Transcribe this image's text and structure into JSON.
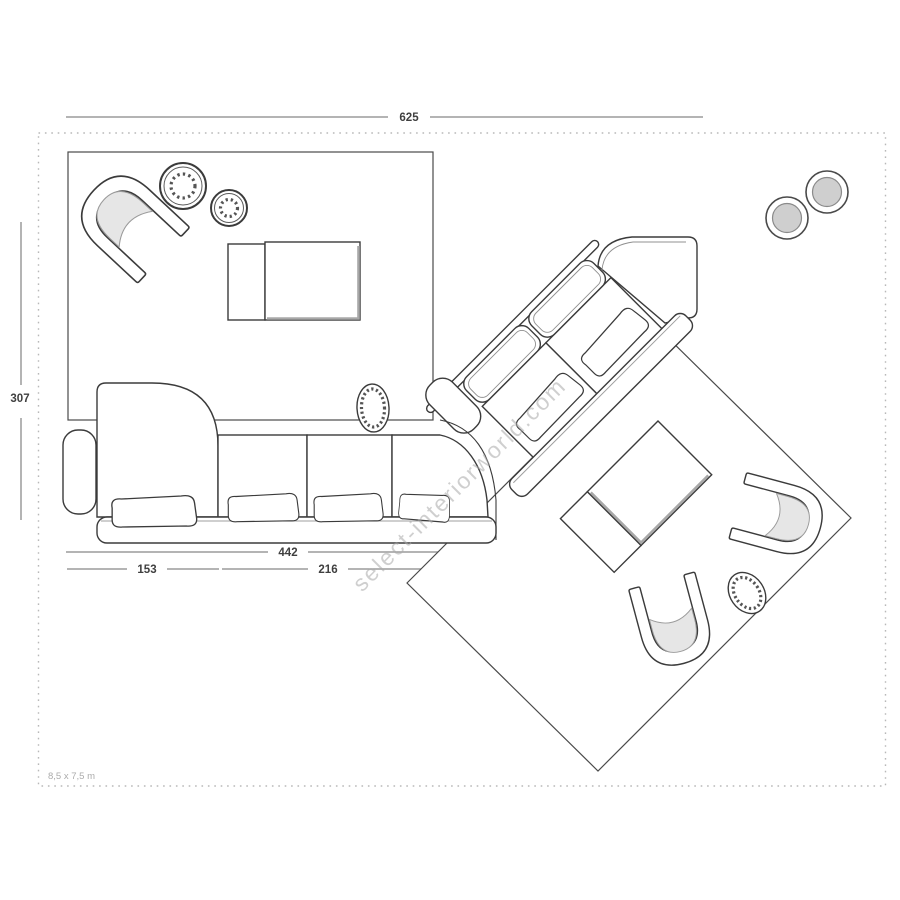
{
  "watermark": "select-interiorworld.com",
  "plan": {
    "room_size_label": "8,5 x 7,5 m",
    "dimensions": {
      "total_width": "625",
      "left_depth": "307",
      "sofa_total": "442",
      "chaise_section": "153",
      "seat_section": "216"
    }
  },
  "colors": {
    "ink": "#3b3b3b",
    "dimension_line": "#9c9c9c",
    "dimension_text": "#3f3f3f",
    "dashed_border": "#b8b8b8",
    "cushion_gray": "#e6e6e6",
    "pouf_gray": "#cfcfcf",
    "watermark_gray": "#a9a9a9"
  }
}
